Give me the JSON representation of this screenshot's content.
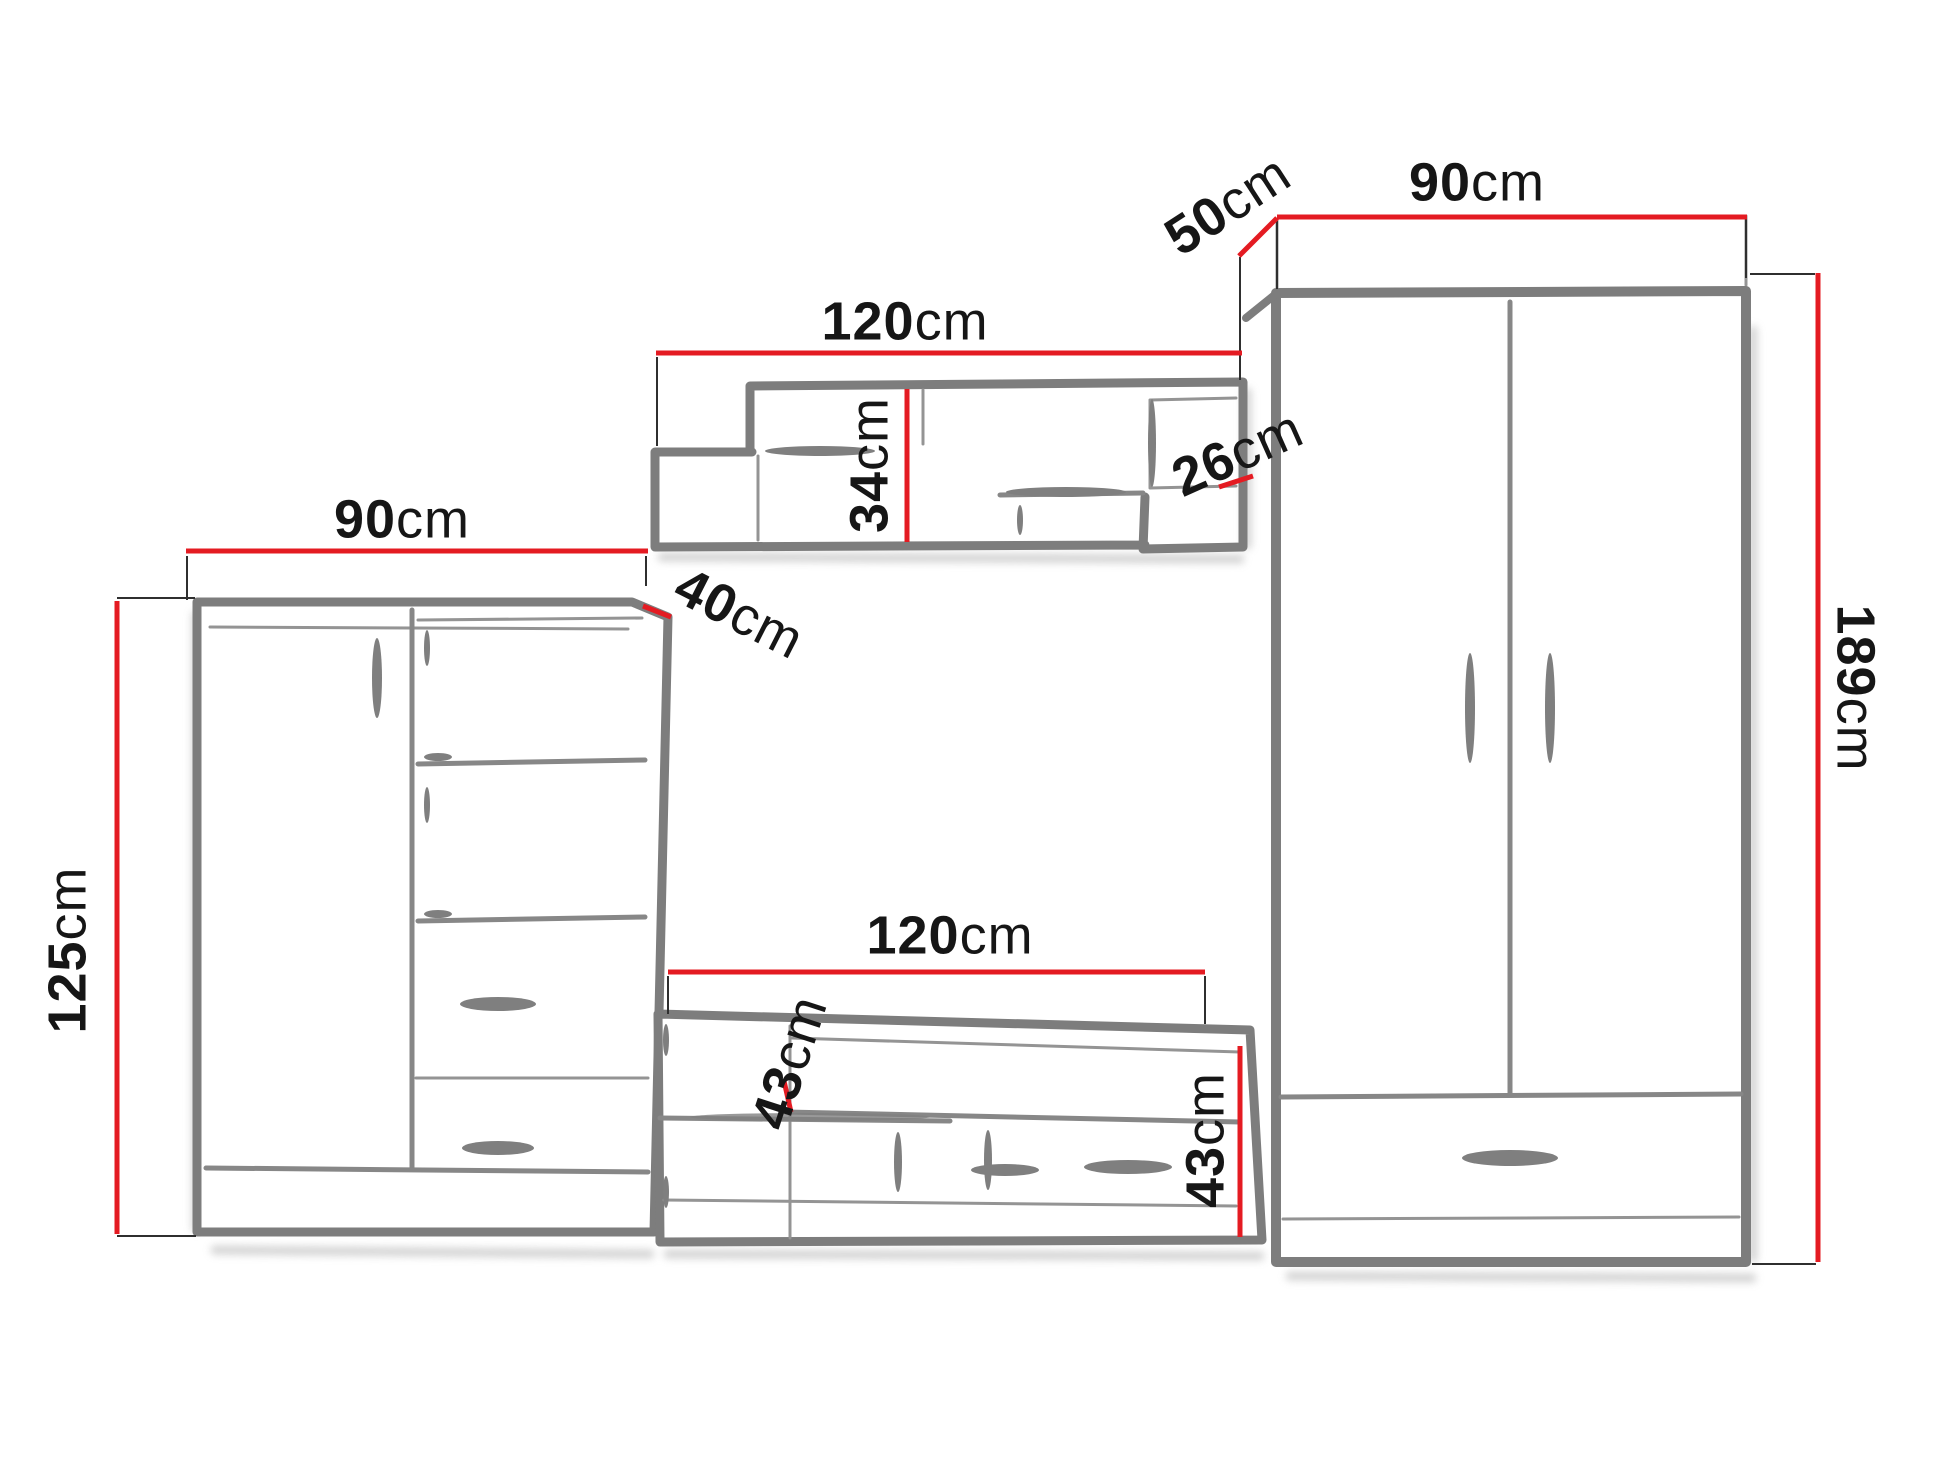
{
  "diagram": {
    "title": "Wall unit furniture dimension diagram",
    "unit": "cm",
    "colors": {
      "dimension_line": "#e41b22",
      "furniture_outline": "#7d7d7d",
      "label_text": "#161616",
      "background": "#ffffff"
    },
    "furniture": {
      "left_cabinet": {
        "width": {
          "number": "90",
          "unit": "cm"
        },
        "height": {
          "number": "125",
          "unit": "cm"
        },
        "depth": {
          "number": "40",
          "unit": "cm"
        }
      },
      "wall_shelf": {
        "width": {
          "number": "120",
          "unit": "cm"
        },
        "height": {
          "number": "34",
          "unit": "cm"
        },
        "end_compartment": {
          "number": "26",
          "unit": "cm"
        }
      },
      "tv_bench": {
        "width": {
          "number": "120",
          "unit": "cm"
        },
        "shelf_height": {
          "number": "43",
          "unit": "cm"
        },
        "height": {
          "number": "43",
          "unit": "cm"
        }
      },
      "wardrobe": {
        "depth": {
          "number": "50",
          "unit": "cm"
        },
        "width": {
          "number": "90",
          "unit": "cm"
        },
        "height": {
          "number": "189",
          "unit": "cm"
        }
      }
    }
  }
}
